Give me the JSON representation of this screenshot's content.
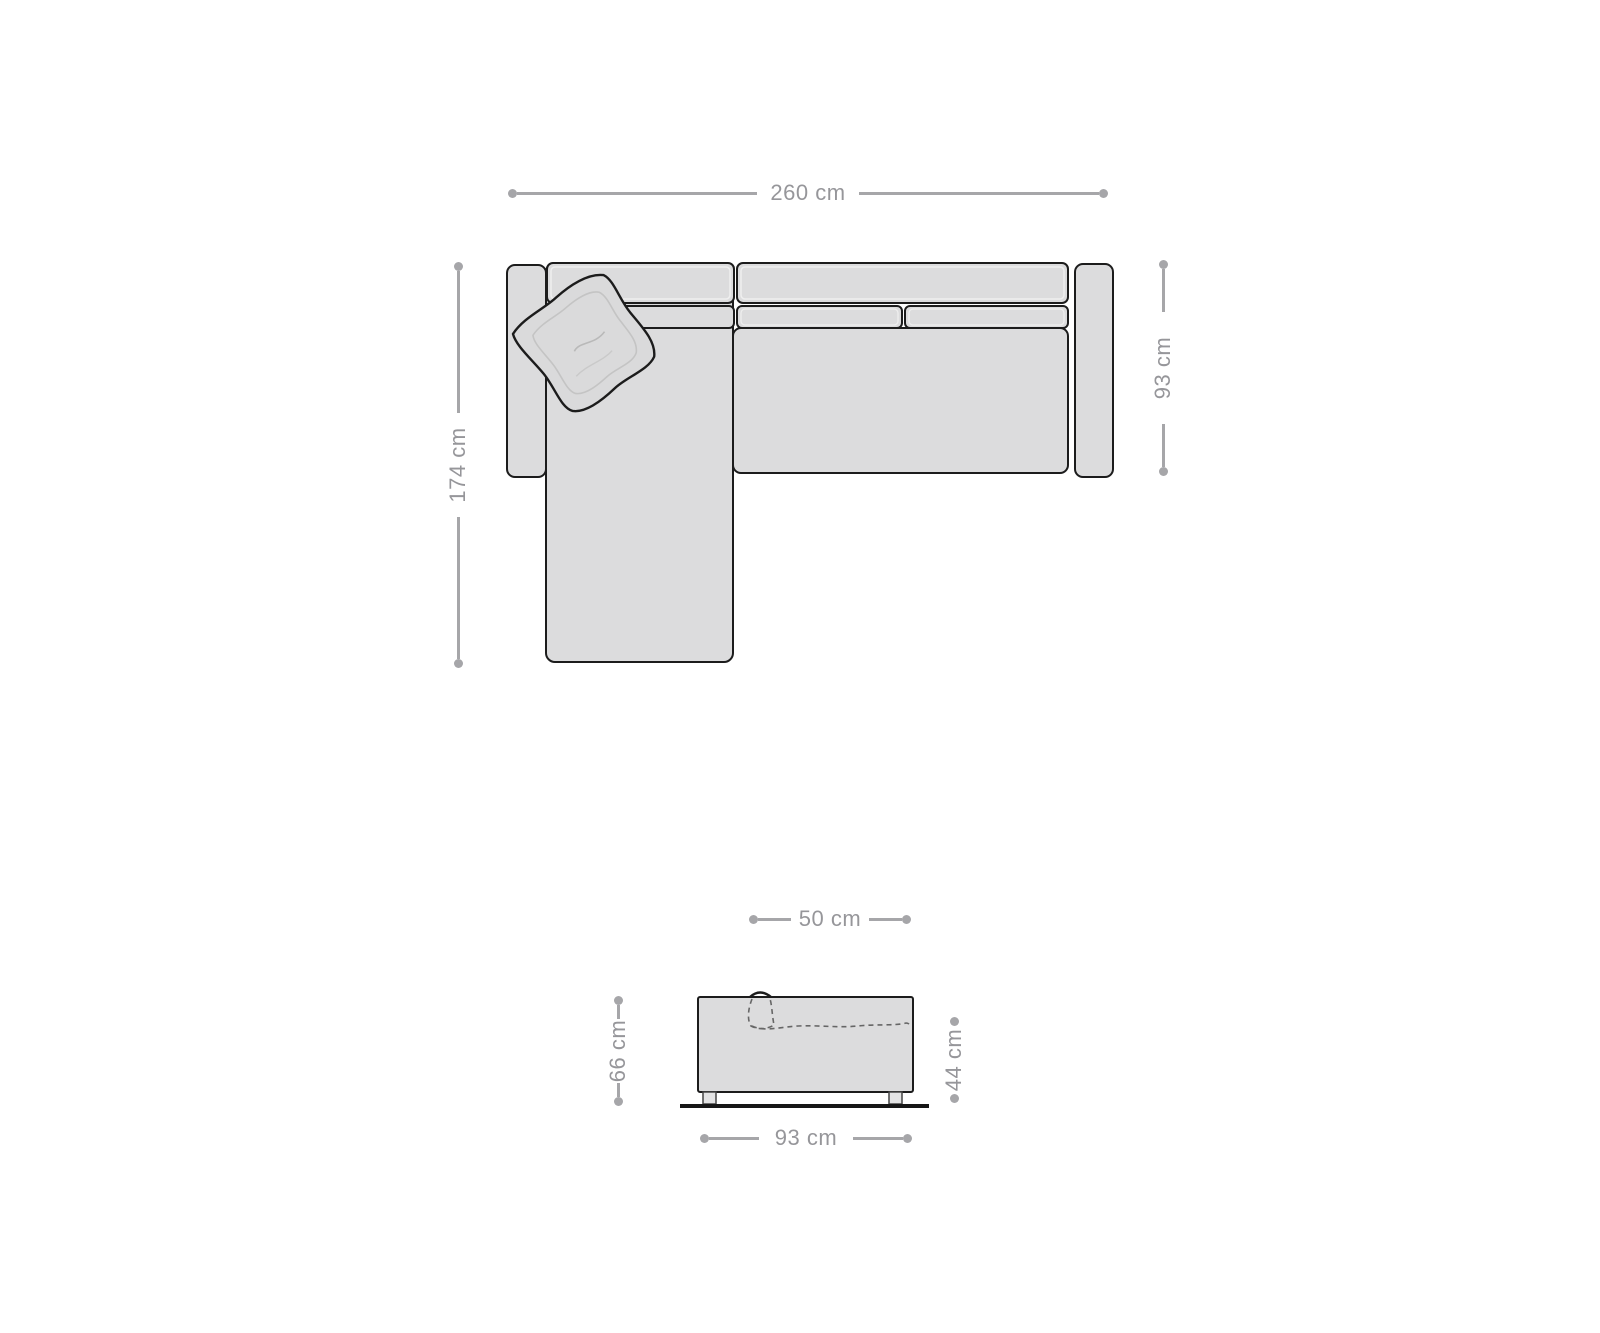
{
  "diagram": {
    "kind": "sofa-dimension-diagram",
    "colors": {
      "background": "#ffffff",
      "dimension_line": "#a6a6a9",
      "dimension_text": "#96969a",
      "sofa_fill": "#dcdcdd",
      "sofa_outline": "#1c1c1c",
      "cushion_highlight": "#efefef",
      "dashed_detail": "#666666",
      "ground_line": "#161616"
    },
    "top_view": {
      "dims": {
        "total_width": "260 cm",
        "chaise_depth": "174 cm",
        "body_depth": "93 cm"
      }
    },
    "side_view": {
      "dims": {
        "seat_depth": "50 cm",
        "total_height": "66 cm",
        "seat_height": "44 cm",
        "total_depth": "93 cm"
      }
    }
  }
}
